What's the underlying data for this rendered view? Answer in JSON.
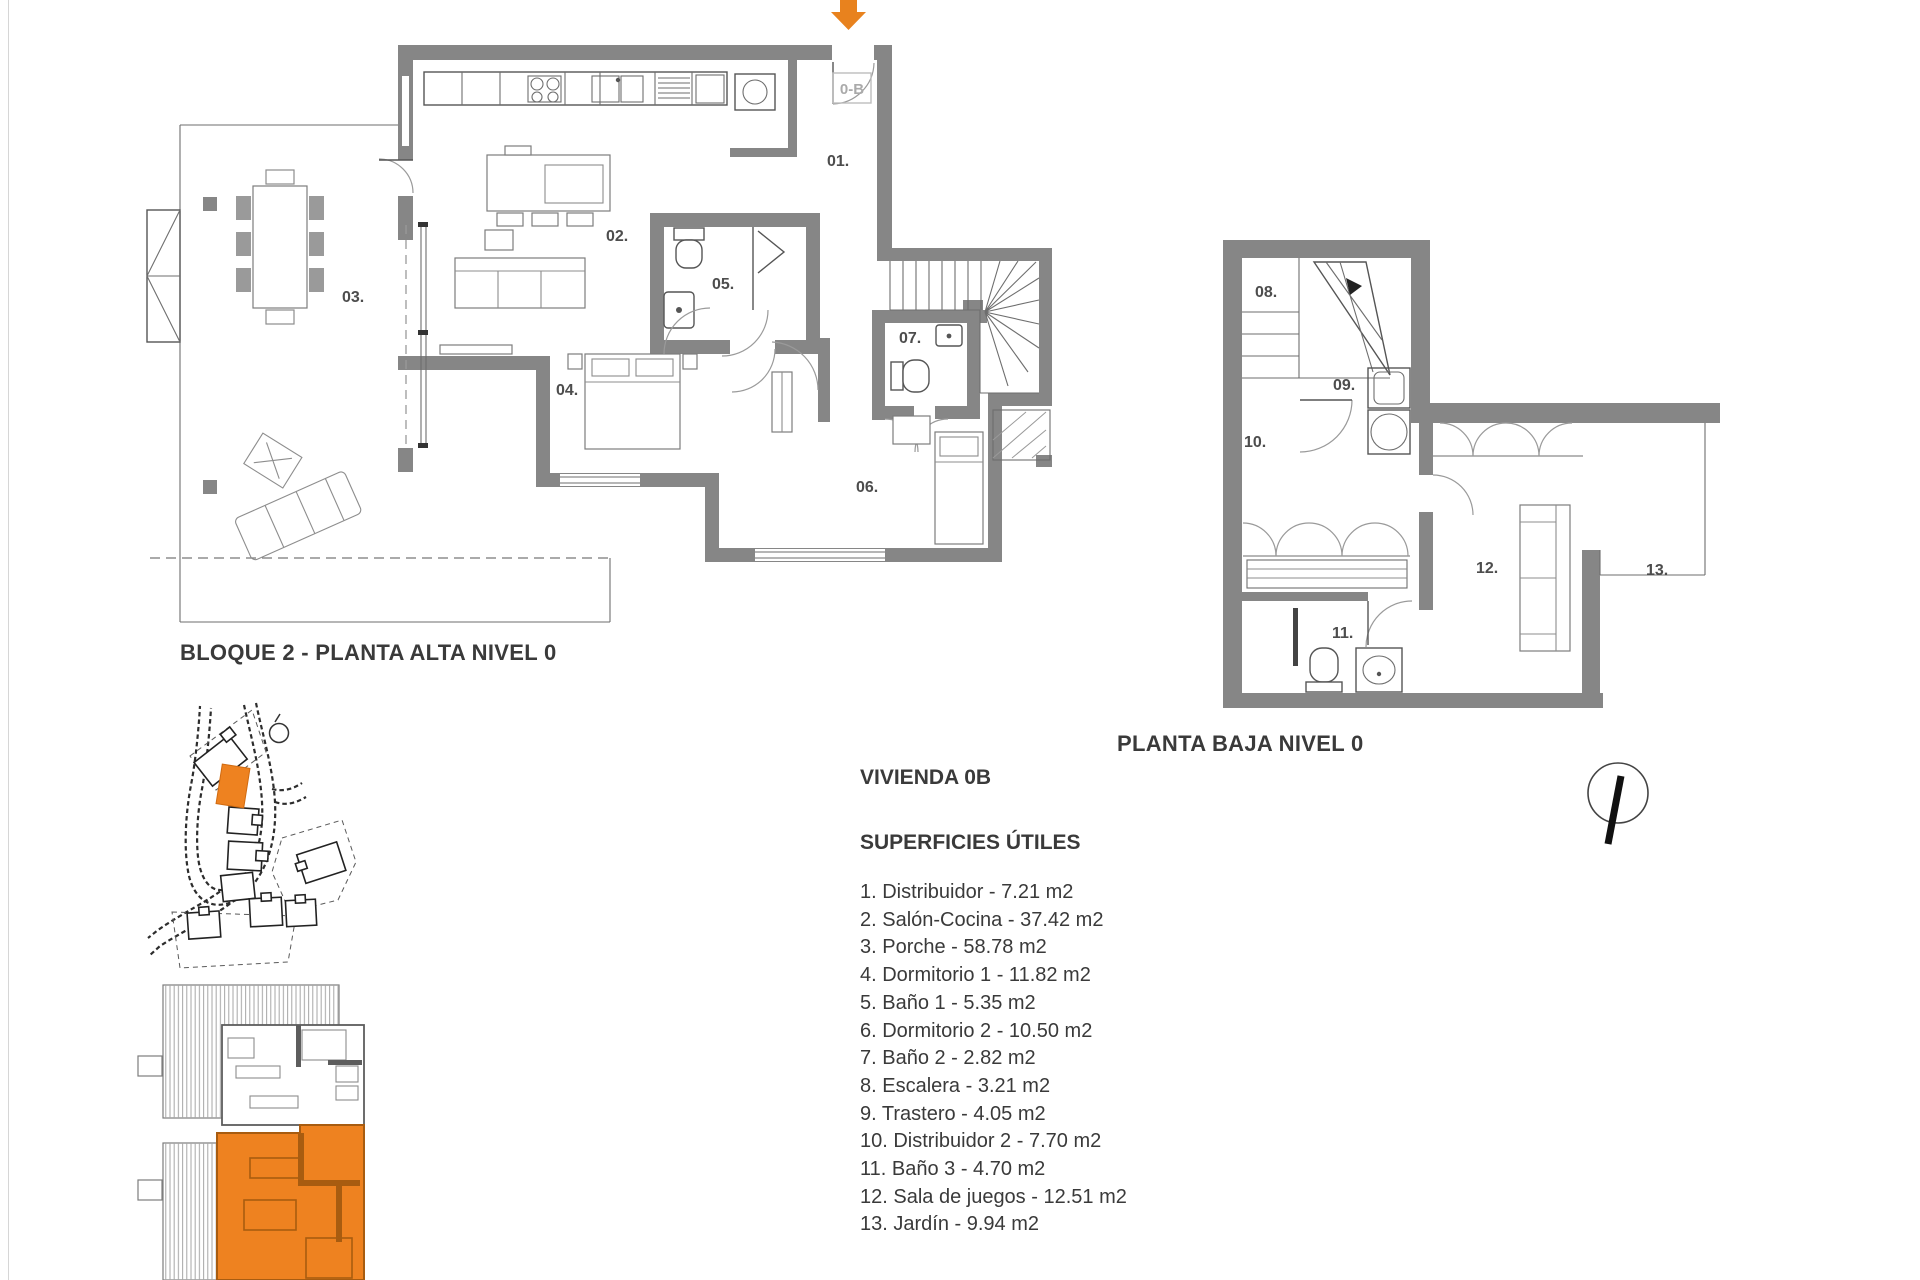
{
  "colors": {
    "accent_orange": "#e8821e",
    "highlight_orange": "#ee8220",
    "wall_gray": "#868686"
  },
  "upper_plan": {
    "caption": "BLOQUE 2 - PLANTA ALTA NIVEL 0",
    "entry_label": "0-B",
    "room_labels": {
      "r01": "01.",
      "r02": "02.",
      "r03": "03.",
      "r04": "04.",
      "r05": "05.",
      "r06": "06.",
      "r07": "07."
    }
  },
  "lower_plan": {
    "caption": "PLANTA BAJA NIVEL 0",
    "room_labels": {
      "r08": "08.",
      "r09": "09.",
      "r10": "10.",
      "r11": "11.",
      "r12": "12.",
      "r13": "13."
    }
  },
  "legend": {
    "title": "VIVIENDA 0B",
    "subtitle": "SUPERFICIES ÚTILES",
    "items": [
      {
        "text": "1. Distribuidor - 7.21 m2"
      },
      {
        "text": "2. Salón-Cocina - 37.42 m2"
      },
      {
        "text": "3. Porche - 58.78 m2"
      },
      {
        "text": "4. Dormitorio 1 - 11.82 m2"
      },
      {
        "text": "5. Baño 1 - 5.35 m2"
      },
      {
        "text": "6. Dormitorio 2 - 10.50 m2"
      },
      {
        "text": "7. Baño 2 - 2.82 m2"
      },
      {
        "text": "8. Escalera - 3.21 m2"
      },
      {
        "text": "9. Trastero - 4.05 m2"
      },
      {
        "text": "10. Distribuidor 2 - 7.70 m2"
      },
      {
        "text": "11. Baño 3 - 4.70 m2"
      },
      {
        "text": "12. Sala de juegos - 12.51 m2"
      },
      {
        "text": "13. Jardín - 9.94 m2"
      }
    ]
  }
}
